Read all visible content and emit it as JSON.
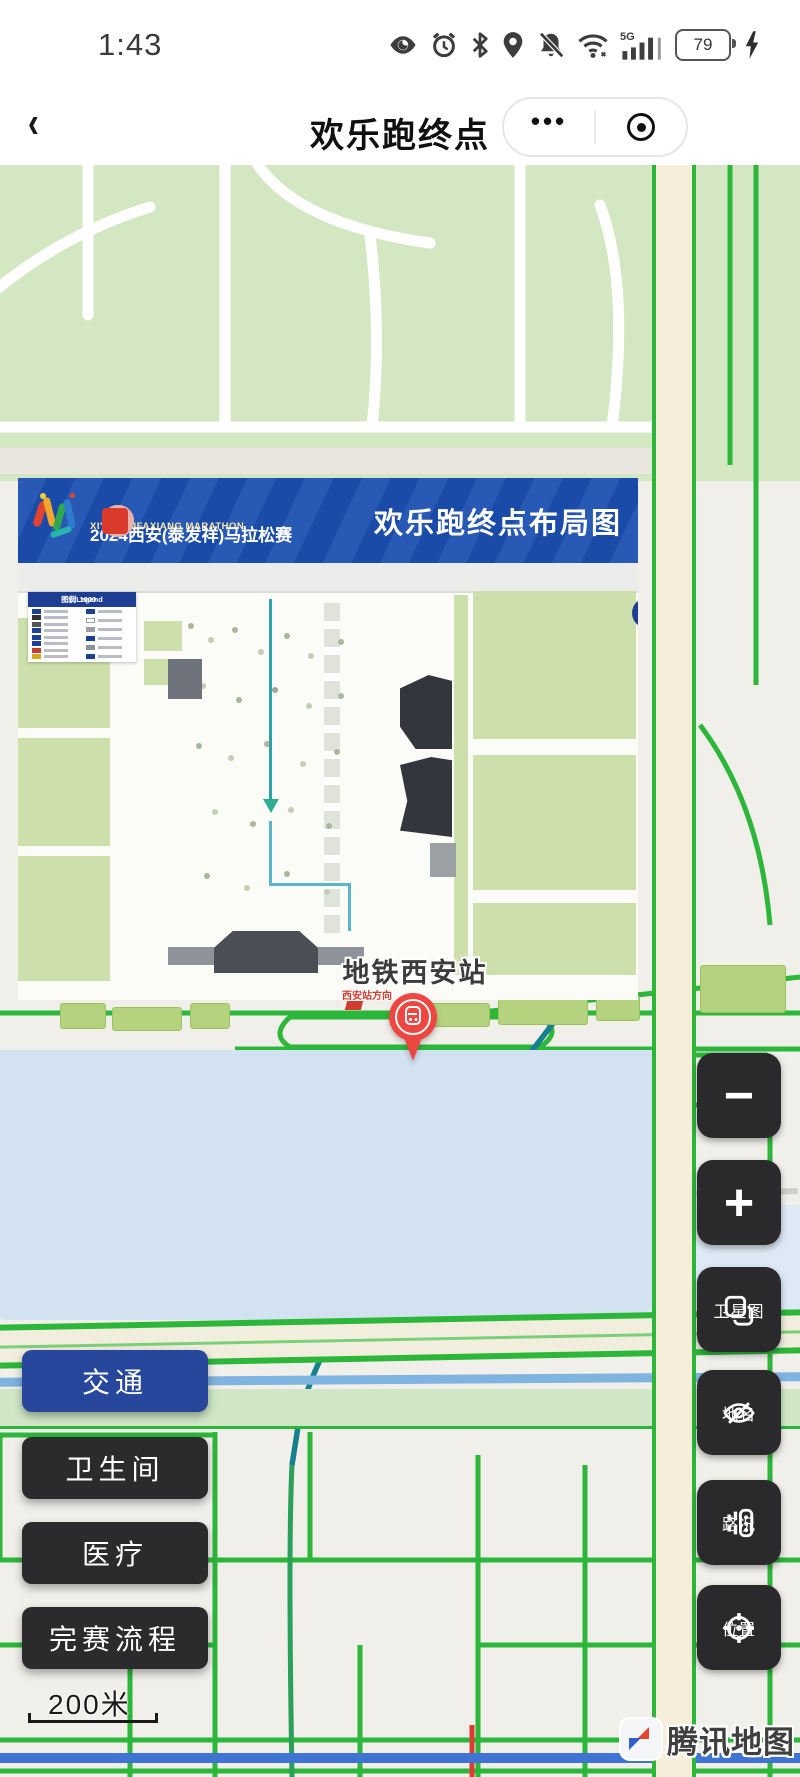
{
  "status_bar": {
    "time": "1:43",
    "battery": "79",
    "network": "5G",
    "icons": [
      "eye-icon",
      "alarm-icon",
      "bluetooth-icon",
      "location-icon",
      "mute-bell-icon",
      "wifi-icon",
      "signal-icon",
      "battery-icon",
      "flash-icon"
    ]
  },
  "nav": {
    "title": "欢乐跑终点",
    "back_glyph": "‹",
    "menu_dots": "•••"
  },
  "banner": {
    "title_cn": "2024西安(泰发祥)马拉松赛",
    "title_en": "XI'AN TAIFAXIANG MARATHON",
    "layout_title": "欢乐跑终点布局图",
    "logo_colors": [
      "#14235e",
      "#ffffff",
      "#7fc4c9",
      "#e8b1ab",
      "#d93a2b"
    ]
  },
  "site_plan": {
    "legend_title": "图例Legend",
    "legend_scale": "1：1000",
    "north_letter": "N",
    "legend_left_chips": [
      "#1d3f96",
      "#333333",
      "#555555",
      "#1d3f96",
      "#1d3f96",
      "#1d3f96",
      "#c43b2e",
      "#d9a520"
    ],
    "legend_right_chips": [
      "#1d3f96",
      "#ffffff",
      "#9aa0a6",
      "#1d3f96",
      "#8d9298",
      "#1d3f96"
    ]
  },
  "map": {
    "station_label": "地铁西安站",
    "station_sub_label": "西安站方向",
    "scale_label": "200米",
    "attribution": "腾讯地图",
    "marker": "metro-station-pin",
    "accent_green": "#2cb63a",
    "water_color": "#d2e2f1",
    "pin_color": "#ee4741"
  },
  "left_buttons": [
    {
      "label": "交通",
      "active": true
    },
    {
      "label": "卫生间",
      "active": false
    },
    {
      "label": "医疗",
      "active": false
    },
    {
      "label": "完赛流程",
      "active": false
    }
  ],
  "right_controls": [
    {
      "icon": "minus",
      "label": ""
    },
    {
      "icon": "plus",
      "label": ""
    },
    {
      "icon": "layers",
      "label": "卫星图"
    },
    {
      "icon": "eye-off",
      "label": "地名"
    },
    {
      "icon": "traffic",
      "label": "路况"
    },
    {
      "icon": "target",
      "label": "位置"
    }
  ]
}
